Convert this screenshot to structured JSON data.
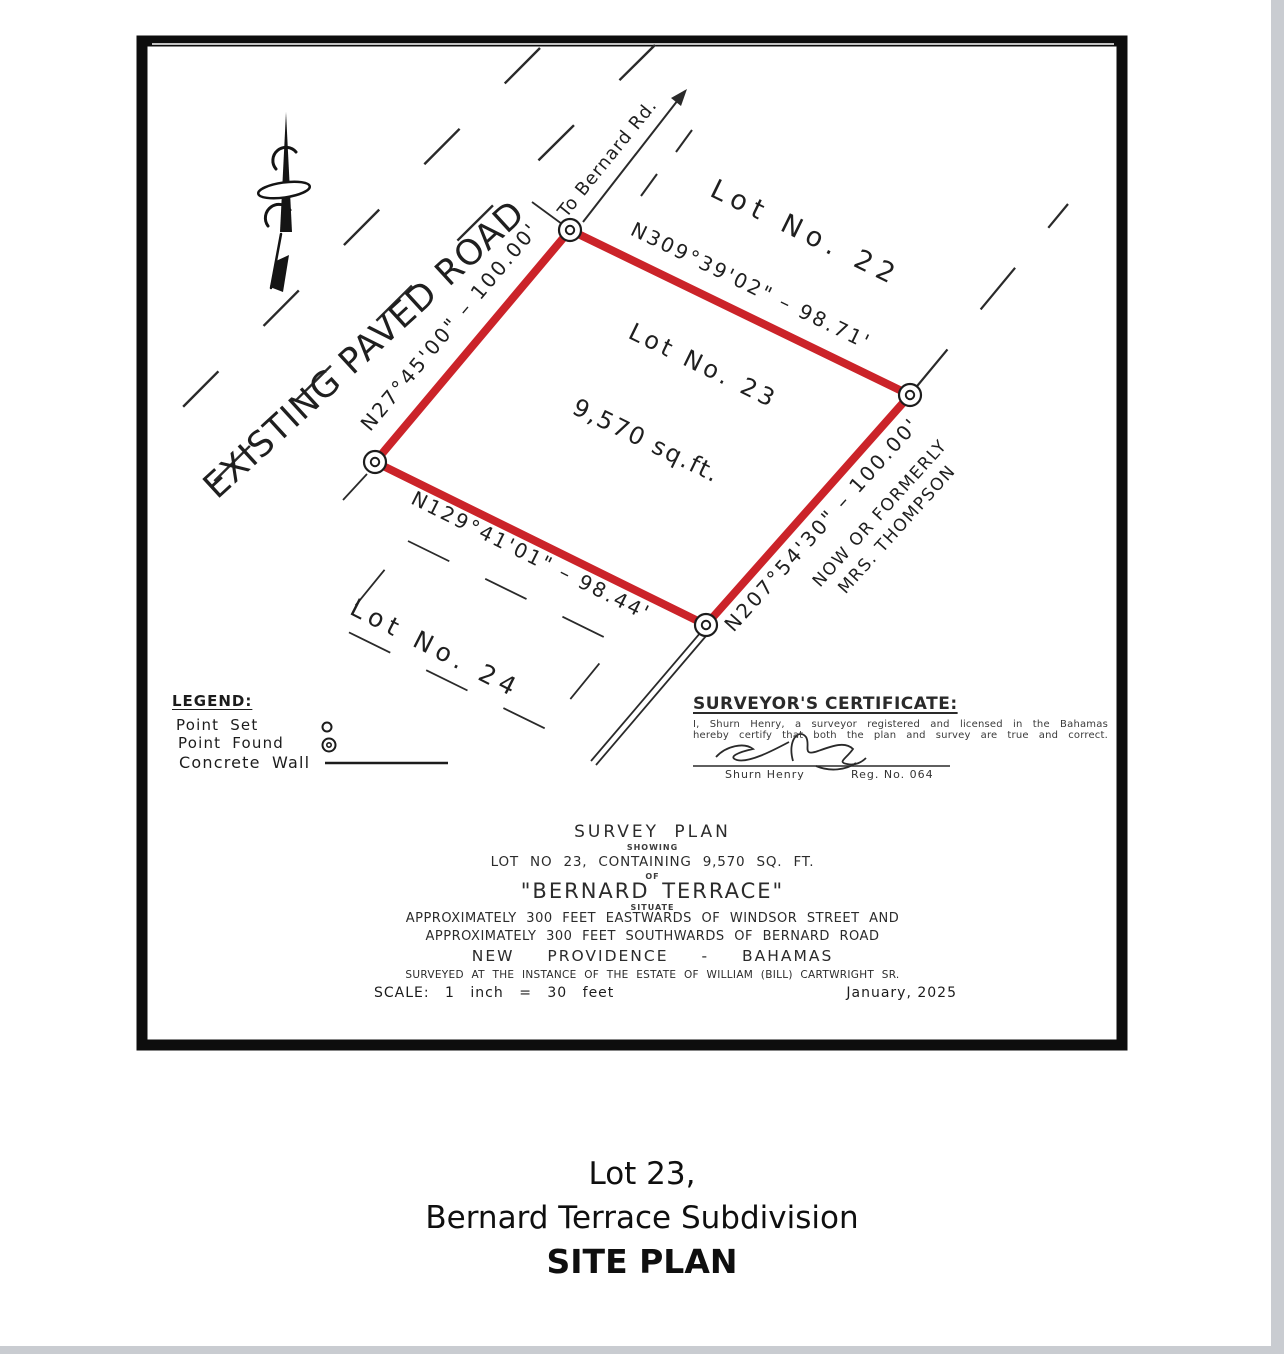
{
  "plan": {
    "road_label": "EXISTING PAVED ROAD",
    "to_road_label": "To Bernard Rd.",
    "lot22_label": "Lot No. 22",
    "lot23_label": "Lot No. 23",
    "lot23_area": "9,570 sq.ft.",
    "lot24_label": "Lot No. 24",
    "adjacent_owner_line1": "NOW OR FORMERLY",
    "adjacent_owner_line2": "MRS. THOMPSON",
    "bearings": {
      "north_side": "N309°39'02\" – 98.71'",
      "west_side": "N27°45'00\" – 100.00'",
      "east_side": "N207°54'30\" – 100.00'",
      "south_side": "N129°41'01\" – 98.44'"
    }
  },
  "legend": {
    "title": "LEGEND:",
    "point_set": "Point Set",
    "point_found": "Point Found",
    "concrete_wall": "Concrete Wall"
  },
  "certificate": {
    "title": "SURVEYOR'S CERTIFICATE:",
    "body_line1": "I, Shurn Henry, a surveyor registered and licensed in the Bahamas",
    "body_line2": "hereby certify that both the plan and survey are true and correct.",
    "signatory": "Shurn Henry",
    "registration": "Reg. No. 064"
  },
  "title_block": {
    "line1": "SURVEY PLAN",
    "line2": "SHOWING",
    "line3": "LOT NO 23, CONTAINING 9,570 SQ. FT.",
    "line4": "OF",
    "line5": "\"BERNARD TERRACE\"",
    "line6": "SITUATE",
    "line7": "APPROXIMATELY 300 FEET EASTWARDS OF WINDSOR STREET AND",
    "line8": "APPROXIMATELY 300 FEET SOUTHWARDS OF BERNARD ROAD",
    "line9": "NEW PROVIDENCE - BAHAMAS",
    "line10": "SURVEYED AT THE INSTANCE OF THE ESTATE OF WILLIAM (BILL) CARTWRIGHT SR.",
    "scale": "SCALE: 1 inch = 30 feet",
    "date": "January, 2025"
  },
  "caption": {
    "line1": "Lot 23,",
    "line2": "Bernard Terrace Subdivision",
    "line3": "SITE PLAN"
  },
  "colors": {
    "boundary_red": "#cb2329",
    "ink": "#1c1c1c"
  }
}
